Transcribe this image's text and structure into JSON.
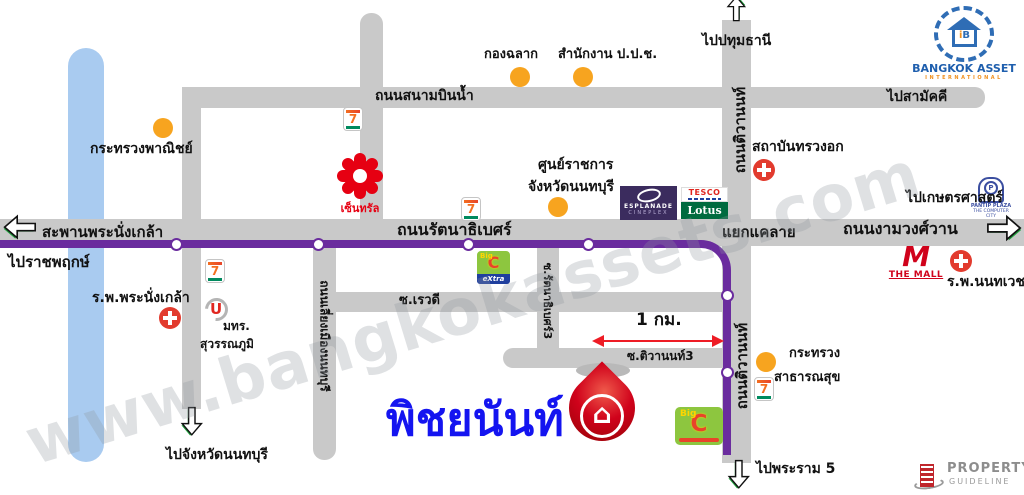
{
  "watermark": "www.bangkokassets.com",
  "destination": "พิชยนันท์",
  "scale": "1 กม.",
  "colors": {
    "road": "#c9c9c9",
    "route_line": "#6a2c9e",
    "river": "#a9cbf0",
    "marker_orange": "#f7a41f",
    "hospital_red": "#e23b2e",
    "destination_blue": "#1414f0",
    "pin_red": "#d0021b"
  },
  "roads": {
    "sanambin": "ถนนสนามบินน้ำ",
    "rattanathibet": "ถนนรัตนาธิเบศร์",
    "ngamwongwan": "ถนนงามวงศ์วาน",
    "bridge": "สะพานพระนั่งเกล้า",
    "junction": "แยกแคลาย",
    "tiwanon": "ถนนติวานนท์",
    "liang_mueang": "ถนนเลี่ยงเมืองนนทบุรี",
    "soi_rewadee": "ซ.เรวดี",
    "soi_rattanathibet3": "ซ.รัตนาธิเบศร์3",
    "soi_tiwanon3": "ซ.ติวานนท์3"
  },
  "directions": {
    "ratchaphruek": "ไปราชพฤกษ์",
    "pathumthani": "ไปปทุมธานี",
    "samakkhi": "ไปสามัคคี",
    "kasetsart": "ไปเกษตรศาสตร์",
    "nonthaburi": "ไปจังหวัดนนทบุรี",
    "rama5": "ไปพระราม 5"
  },
  "places": {
    "commerce": "กระทรวงพาณิชย์",
    "lottery": "กองฉลาก",
    "nacc": "สำนักงาน ป.ป.ช.",
    "govcenter1": "ศูนย์ราชการ",
    "govcenter2": "จังหวัดนนทบุรี",
    "chest": "สถาบันทรวงอก",
    "prananklao": "ร.พ.พระนั่งเกล้า",
    "rmut1": "มทร.",
    "rmut2": "สุวรรณภูมิ",
    "health1": "กระทรวง",
    "health2": "สาธารณสุข",
    "nonthavej": "ร.พ.นนทเวช"
  },
  "logos": {
    "central": "เซ็นทรัล",
    "esplanade1": "ESPLANADE",
    "esplanade2": "CINEPLEX",
    "tesco": "TESCO",
    "lotus": "Lotus",
    "pantip_p": "P",
    "pantip1": "PANTIP PLAZA",
    "pantip2": "THE COMPUTER CITY",
    "seven": "7",
    "u": "U",
    "bigc_big": "Big",
    "bigc_c": "C",
    "bigc_extra": "eXtra",
    "mall_m": "M",
    "mall_name": "THE MALL",
    "ba_i": "i",
    "ba_b": "B",
    "ba1": "BANGKOK ASSET",
    "ba2": "INTERNATIONAL",
    "pg1": "PROPERTY",
    "pg2": "GUIDELINE"
  },
  "icons": {
    "house": "⌂"
  }
}
